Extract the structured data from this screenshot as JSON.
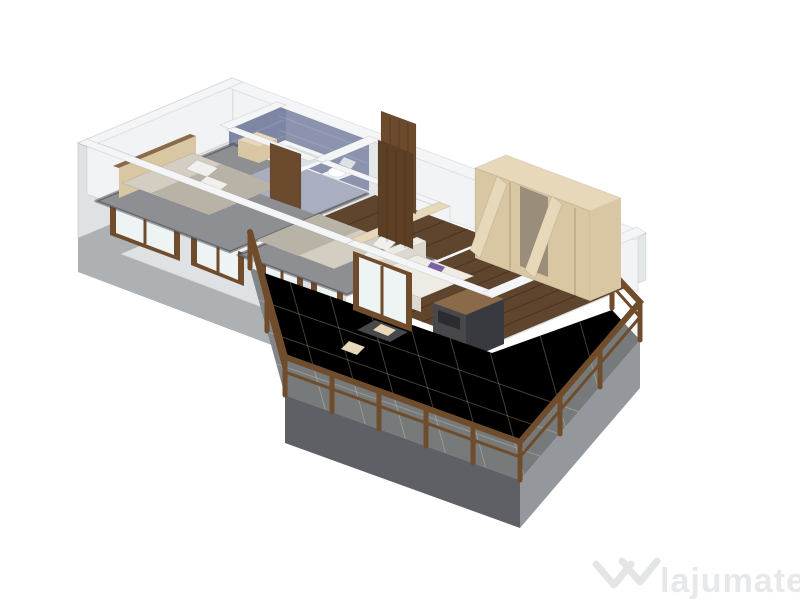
{
  "canvas": {
    "width": 800,
    "height": 600,
    "background": "#ffffff"
  },
  "watermark": {
    "brand": "lajumate",
    "tld": ".ro",
    "brand_color": "#e7e8e9",
    "tld_color": "#5fc4c6",
    "logo_color": "#e4e5e6"
  },
  "colors": {
    "wall_top": "#f4f5f6",
    "wall_inner": "#f2f3f4",
    "wall_shade": "#e4e7e8",
    "ext_face": "#dfe2e4",
    "slab": "#aeb1b4",
    "slab_dark": "#5e6066",
    "slab_right": "#94979c",
    "carpet": "#8e8f92",
    "wood_floor": "#5f452e",
    "bath_floor": "#a9aec0",
    "tile_blue": "#8b93ae",
    "tile_blue_dark": "#7d86a4",
    "frame_wood": "#6f4c2c",
    "glass": "#eef3f4",
    "fixture_white": "#f4f6f7",
    "fixture_shade": "#dde3e5",
    "cream": "#e8d8ba",
    "cream_face": "#d9c6a2",
    "wardrobe_inner": "#9a8e7b",
    "linen": "#d3cdc2",
    "blanket": "#b9b2a6",
    "pillow": "#f1f0ed",
    "headboard_wood": "#8a6a48",
    "sofa": "#eeebe4",
    "sofa_shade": "#dcd8cf",
    "purple": "#7c60a6",
    "dark_unit": "#47474c",
    "dark_unit_side": "#393a3f",
    "dark_slot": "#2c2c30",
    "door_brown": "#6b4a2e",
    "door_brown_dark": "#5d3f26"
  },
  "scene": {
    "type": "3d-floorplan-render",
    "rooms": [
      "bedroom-1",
      "bathroom",
      "hallway",
      "bedroom-2",
      "living-room",
      "balcony"
    ],
    "objects": [
      "double-bed",
      "nightstand",
      "bathtub",
      "toilet",
      "interior-doors",
      "double-bed-2",
      "built-in-unit",
      "wardrobe",
      "sofa",
      "coffee-table",
      "tv-unit",
      "balcony-railing",
      "windows"
    ]
  }
}
